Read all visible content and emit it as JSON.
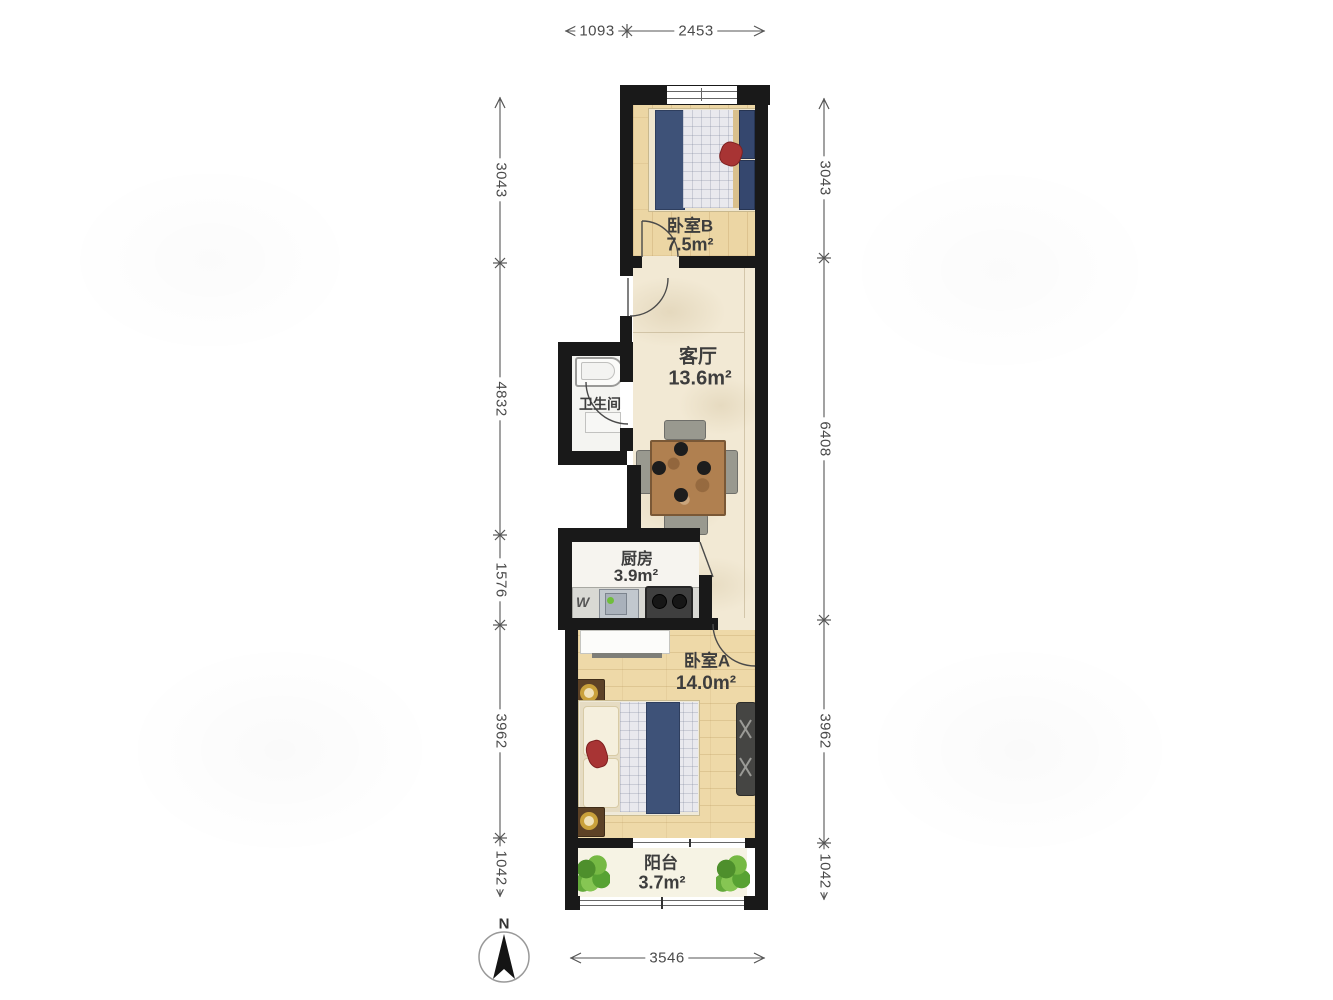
{
  "plan": {
    "rooms": [
      {
        "name": "卧室B",
        "area": "7.5m²"
      },
      {
        "name": "客厅",
        "area": "13.6m²"
      },
      {
        "name": "卫生间",
        "area": ""
      },
      {
        "name": "厨房",
        "area": "3.9m²"
      },
      {
        "name": "卧室A",
        "area": "14.0m²"
      },
      {
        "name": "阳台",
        "area": "3.7m²"
      }
    ],
    "dims": {
      "top": [
        {
          "value": "1093"
        },
        {
          "value": "2453"
        }
      ],
      "left": [
        {
          "value": "3043"
        },
        {
          "value": "4832"
        },
        {
          "value": "1576"
        },
        {
          "value": "3962"
        },
        {
          "value": "1042"
        }
      ],
      "right": [
        {
          "value": "3043"
        },
        {
          "value": "6408"
        },
        {
          "value": "3962"
        },
        {
          "value": "1042"
        }
      ],
      "bottom": [
        {
          "value": "3546"
        }
      ]
    },
    "compass": {
      "north_label": "N"
    },
    "kitchen_marker": "W",
    "colors": {
      "wall": "#191919",
      "wood_floor": "#ecd6a4",
      "marble_floor": "#f2e9d4",
      "bedding_navy": "#3e5278",
      "accent_red": "#a83434",
      "plant_green": "#5a9e32",
      "counter_gray": "#d9d9d4"
    }
  }
}
